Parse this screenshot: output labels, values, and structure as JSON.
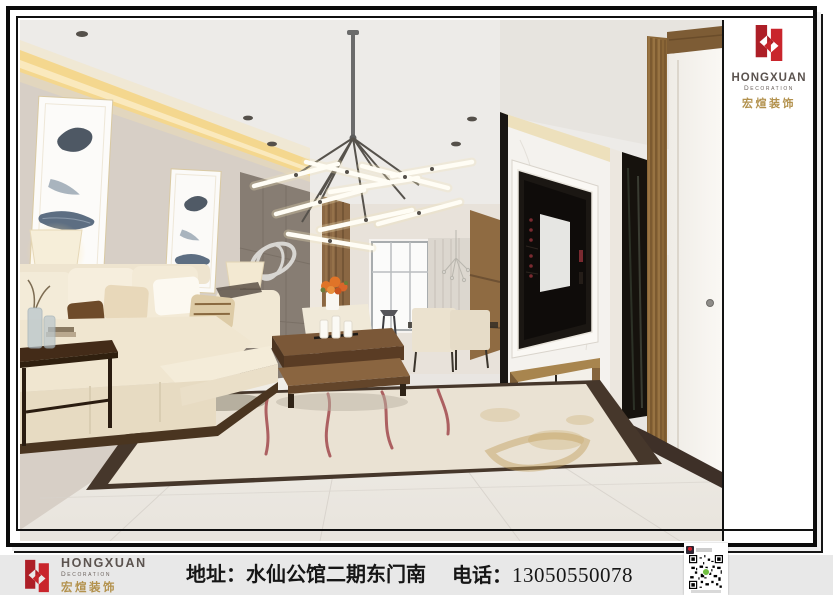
{
  "brand": {
    "name": "HONGXUAN",
    "subtitle": "Decoration",
    "chinese": "宏煊装饰",
    "accent_red": "#c2272d",
    "accent_gold": "#b3924e",
    "text_dark": "#57504b"
  },
  "footer": {
    "address_label": "地址：",
    "address_value": "水仙公馆二期东门南",
    "phone_label": "电话：",
    "phone_number": "13050550078",
    "background": "#e8e8e8"
  },
  "icons": {
    "logo_monogram": "hongxuan-h-monogram",
    "qr": "wechat-contact-qr-code",
    "avatar": "wechat-avatar"
  },
  "scene": {
    "subject": "modern living room interior rendering",
    "elements": "cream sofa, feather wall art, sputnik chandelier, marble TV wall, wood pillar, white door, marble rug inlay floor"
  }
}
